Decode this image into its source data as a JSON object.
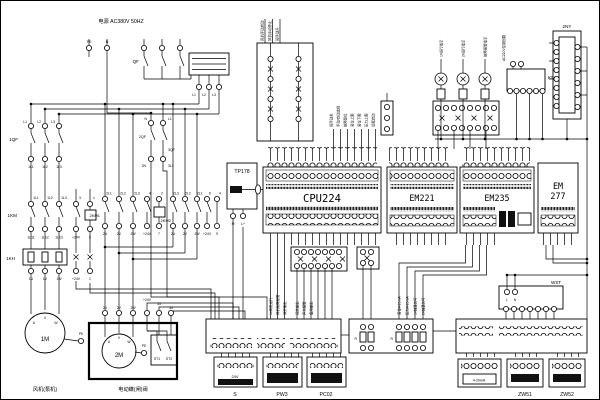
{
  "title": "电源 AC380V 50HZ",
  "power": {
    "pe": "PE",
    "n": "N",
    "qf": "QF",
    "l1": "L1",
    "l2": "L2",
    "l3": "L3"
  },
  "feeder1": {
    "breaker": "1QF",
    "kt1": "1L1",
    "kt2": "1L2",
    "kt3": "1L3",
    "kt4": "3",
    "kt5": "1",
    "in1": "L1",
    "in2": "L2",
    "in3": "L3",
    "out1": "1L1",
    "out2": "1L2",
    "out3": "1L3",
    "contactor": "1KM",
    "kb1": "1L11",
    "kb2": "1L12",
    "kb3": "1L13",
    "kb4": "+24V",
    "kb5": "5",
    "thermal": "1KH",
    "tb1": "1U",
    "tb2": "1V",
    "tb3": "1W",
    "tb4": "+24V",
    "tb5": "1",
    "motor": "1M",
    "mu": "U",
    "mv": "V",
    "mw": "W",
    "pe": "PE",
    "caption": "风机(泵机)"
  },
  "feeder2": {
    "contactor1": "2KM1",
    "a1": "2L1",
    "a2": "2L2",
    "a3": "2L3",
    "a4": "4",
    "a5": "2",
    "b1": "2U",
    "b2": "2V",
    "b3": "2W",
    "b4": "+24V",
    "b5": "7",
    "contactor2": "2KM2",
    "c1": "2L3",
    "c2": "2L2",
    "c3": "2L1",
    "c4": "6",
    "c5": "4",
    "d1": "2U",
    "d2": "2V",
    "d3": "2W",
    "d4": "+24V",
    "d5": "9"
  },
  "valve": {
    "t1": "2U",
    "t2": "2V",
    "t3": "2W",
    "t4": "+24V",
    "t5": "33",
    "t6": "34",
    "motor": "2M",
    "mu": "U",
    "mv": "V",
    "mw": "W",
    "pe": "PE",
    "st1": "ST1",
    "st2": "ST2",
    "caption": "电动蝶(闸)阀"
  },
  "aux": {
    "b2": "2QF",
    "b2in": "N",
    "b2out": "2N",
    "b3": "3QF",
    "b3in": "L1",
    "b3out": "3L1"
  },
  "hmi": {
    "name": "TP178",
    "m": "M",
    "lp": "L+"
  },
  "plc": {
    "cpu": "CPU224",
    "em221": "EM221",
    "em235": "EM235",
    "em277a": "EM",
    "em277b": "277"
  },
  "di_labels": [
    "风机手动启动",
    "风机手动停止",
    "阀手动开",
    "阀手动关",
    "手动/自动选择",
    "故障复位",
    "液位上限",
    "液位下限",
    "压力上限",
    "远程启动"
  ],
  "do_labels": [
    "1#风机运行",
    "风机故障报警",
    "阀开输出",
    "阀关输出",
    "声光报警",
    "备用输出"
  ],
  "ai_labels": [
    "液位4-20mA",
    "压力4-20mA",
    "1#轴温信号",
    "2#轴温信号"
  ],
  "lamps": {
    "lamp1": "1#运行指示",
    "lamp2": "2#运行指示",
    "lamp3": "故障报警指示",
    "relay": "K5A",
    "module": "2NY",
    "bus": "AC220V控制回路"
  },
  "bottom": {
    "s": "S",
    "s_text": "24V",
    "pw3": "PW3",
    "pc02": "PC02",
    "r": "R"
  },
  "right": {
    "wst": "WST",
    "l": "L",
    "n": "N",
    "tx": "4-20mA",
    "zw51": "ZW51",
    "zw52": "ZW52"
  }
}
